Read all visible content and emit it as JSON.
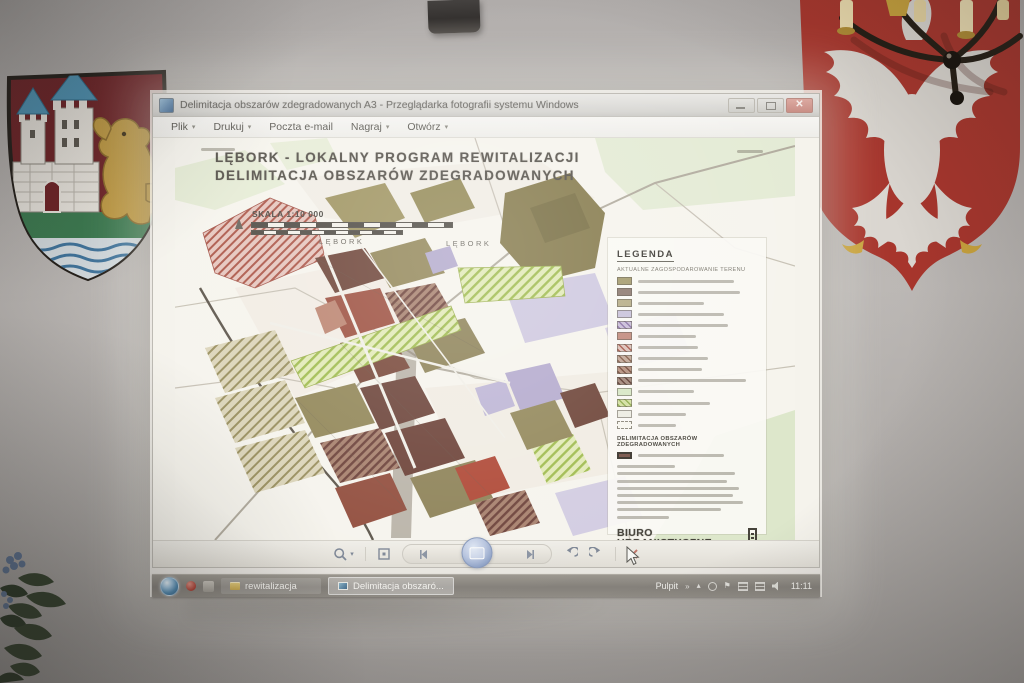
{
  "icons": {
    "caret_down": "▾",
    "tray_chevron": "»",
    "tray_flag": "⚑",
    "tray_arrow": "▴"
  },
  "window": {
    "title": "Delimitacja obszarów zdegradowanych A3 - Przeglądarka fotografii systemu Windows",
    "menu": [
      {
        "label": "Plik",
        "caret": true
      },
      {
        "label": "Drukuj",
        "caret": true
      },
      {
        "label": "Poczta e-mail",
        "caret": false
      },
      {
        "label": "Nagraj",
        "caret": true
      },
      {
        "label": "Otwórz",
        "caret": true
      }
    ]
  },
  "map": {
    "title_line1": "LĘBORK - LOKALNY PROGRAM REWITALIZACJI",
    "title_line2": "DELIMITACJA OBSZARÓW ZDEGRADOWANYCH",
    "scale_label": "SKALA 1:10 000",
    "city_labels": [
      "LĘBORK",
      "LĘBORK"
    ],
    "legend": {
      "heading": "LEGENDA",
      "subheading": "AKTUALNE ZAGOSPODAROWANIE TERENU",
      "section2_heading": "DELIMITACJA OBSZARÓW ZDEGRADOWANYCH",
      "logo_line1": "BIURO",
      "logo_line2": "URBANISTYCZNE",
      "items": [
        {
          "fill": "#a59c6e"
        },
        {
          "fill": "#8e7b71"
        },
        {
          "fill": "#b7ae88"
        },
        {
          "fill": "#c9c3da"
        },
        {
          "fill": "#cabed8",
          "stripe": "#8e76a8"
        },
        {
          "fill": "#c28b7e"
        },
        {
          "fill": "#dcc0b8",
          "stripe": "#a85a4c"
        },
        {
          "fill": "#c2a898",
          "stripe": "#86604c"
        },
        {
          "fill": "#b5917f",
          "stripe": "#774c3c"
        },
        {
          "fill": "#a3887b",
          "stripe": "#5e3c33"
        },
        {
          "fill": "#d8e7c6"
        },
        {
          "fill": "#d4e0a2",
          "stripe": "#93ae52"
        },
        {
          "fill": "#edece2"
        },
        {
          "fill": "#f7f6ef",
          "dashed": true
        }
      ]
    }
  },
  "taskbar": {
    "buttons": [
      {
        "label": "rewitalizacja"
      },
      {
        "label": "Delimitacja obszaró..."
      }
    ],
    "tray_label": "Pulpit",
    "clock": "11:11"
  },
  "colors": {
    "shield_red": "#a7352c",
    "crest_red": "#6f2327",
    "eagle_white": "#dad6d0",
    "lion_gold": "#c09a42",
    "accent_blue": "#4f93b4"
  }
}
